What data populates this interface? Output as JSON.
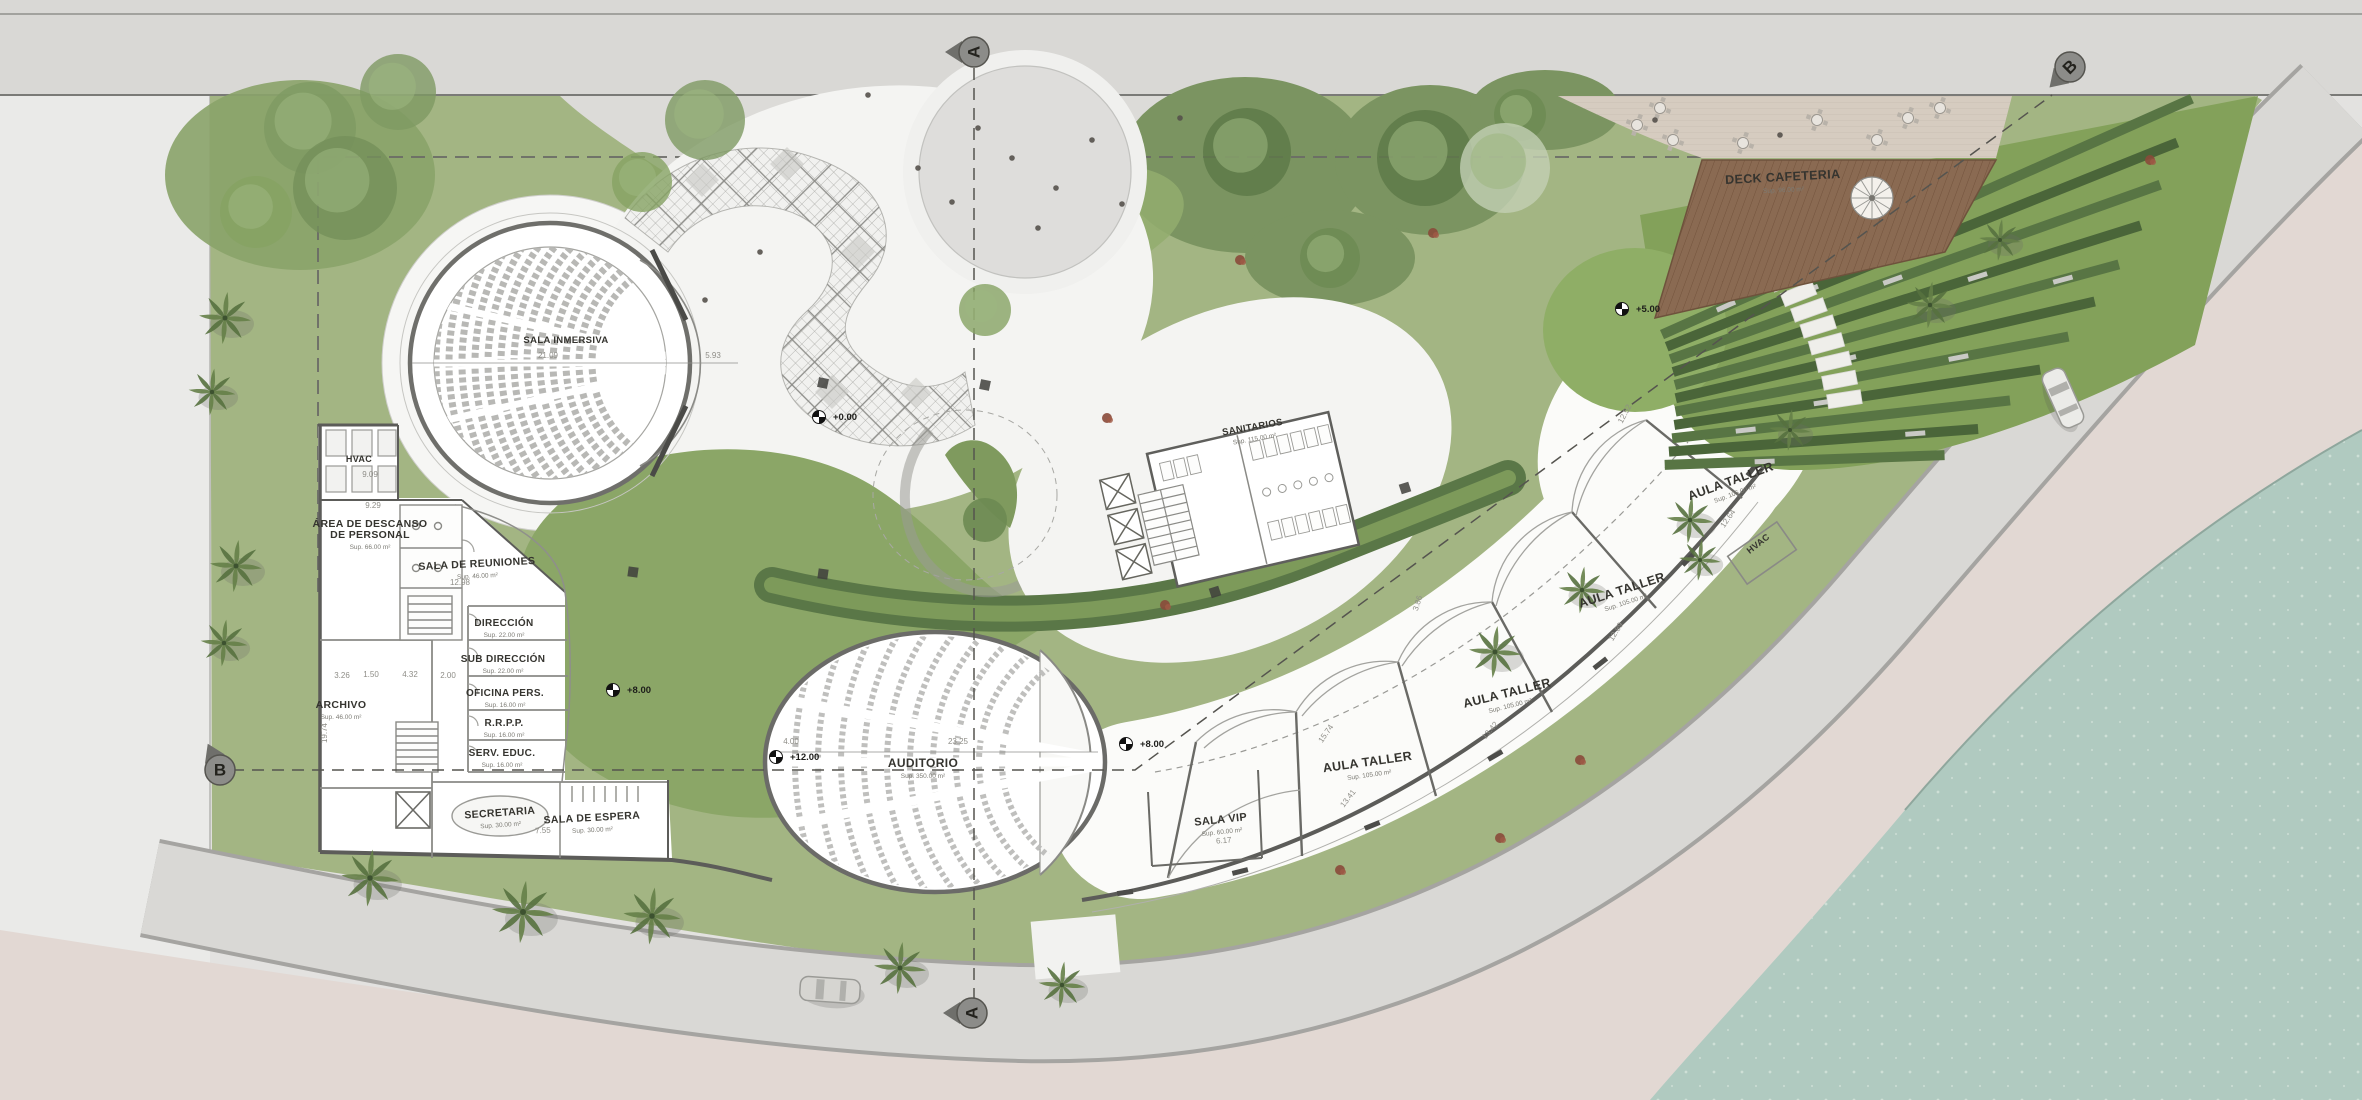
{
  "site": {
    "plan_type": "architectural ground floor plan",
    "rooms": [
      {
        "name": "SALA INMERSIVA",
        "area": ""
      },
      {
        "name": "HVAC",
        "area": ""
      },
      {
        "name": "ÁREA DE DESCANSO",
        "line2": "DE PERSONAL",
        "area": "Sup. 66.00 m²"
      },
      {
        "name": "SALA DE REUNIONES",
        "area": "Sup. 46.00 m²"
      },
      {
        "name": "DIRECCIÓN",
        "area": "Sup. 22.00 m²"
      },
      {
        "name": "SUB DIRECCIÓN",
        "area": "Sup. 22.00 m²"
      },
      {
        "name": "OFICINA PERS.",
        "area": "Sup. 16.00 m²"
      },
      {
        "name": "R.R.P.P.",
        "area": "Sup. 16.00 m²"
      },
      {
        "name": "SERV. EDUC.",
        "area": "Sup. 16.00 m²"
      },
      {
        "name": "ARCHIVO",
        "area": "Sup. 46.00 m²"
      },
      {
        "name": "SECRETARIA",
        "area": "Sup. 30.00 m²"
      },
      {
        "name": "SALA DE ESPERA",
        "area": "Sup. 30.00 m²"
      },
      {
        "name": "AUDITORIO",
        "area": "Sup. 350.00 m²"
      },
      {
        "name": "SANITARIOS",
        "area": "Sup. 115.00 m²"
      },
      {
        "name": "SALA VIP",
        "area": "Sup. 60.00 m²"
      },
      {
        "name": "AULA TALLER",
        "area": "Sup. 105.00 m²"
      },
      {
        "name": "AULA TALLER",
        "area": "Sup. 105.00 m²"
      },
      {
        "name": "AULA TALLER",
        "area": "Sup. 105.00 m²"
      },
      {
        "name": "AULA TALLER",
        "area": "Sup. 105.00 m²"
      },
      {
        "name": "HVAC",
        "area": ""
      },
      {
        "name": "DECK CAFETERIA",
        "area": "Sup. 96.00 m²"
      }
    ],
    "dimensions": [
      "21.09",
      "5.93",
      "9.09",
      "9.29",
      "12.98",
      "3.26",
      "1.50",
      "4.32",
      "2.00",
      "19.74",
      "7.55",
      "4.00",
      "23.25",
      "6.17",
      "13.41",
      "15.74",
      "13.42",
      "3.86",
      "12.89",
      "12.64",
      "12.52"
    ],
    "levels": [
      "+0.00",
      "+12.00",
      "+8.00",
      "+8.00",
      "+5.00"
    ],
    "sections": [
      "A",
      "A",
      "B",
      "B"
    ],
    "colors": {
      "grass": "#a3b583",
      "courtyard_grass": "#8ba667",
      "dark_hedge": "#5a7747",
      "terrace_strip": "#4a6539",
      "water": "#b0cac0",
      "sand": "#e2d8d3",
      "deck_wood": "#8a6a52",
      "road": "#d9d8d5",
      "building": "#ffffff",
      "wall": "#5c5c59"
    }
  }
}
